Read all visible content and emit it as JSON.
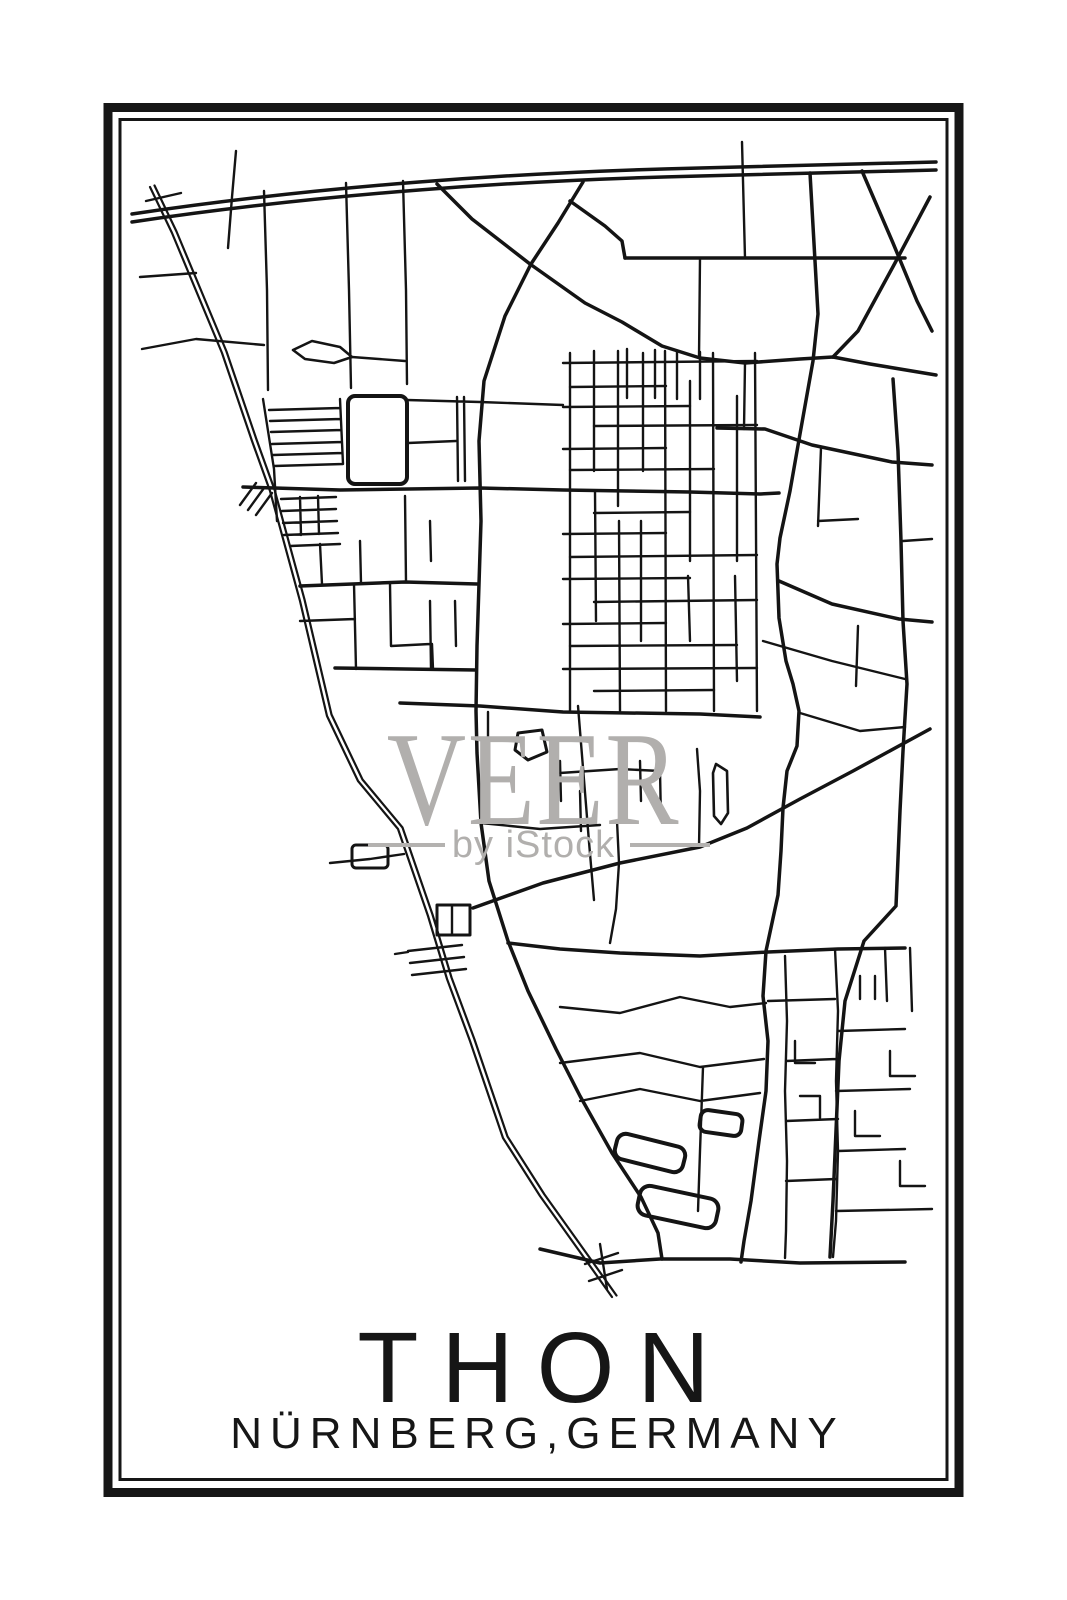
{
  "poster": {
    "title": "THON",
    "subtitle": "NÜRNBERG,GERMANY",
    "style": "minimalist black line-art street map poster",
    "colors": {
      "ink": "#161616",
      "paper": "#ffffff",
      "watermark_gray": "#b1afad"
    }
  },
  "watermark": {
    "brand": "VEER",
    "byline": "by iStock"
  }
}
